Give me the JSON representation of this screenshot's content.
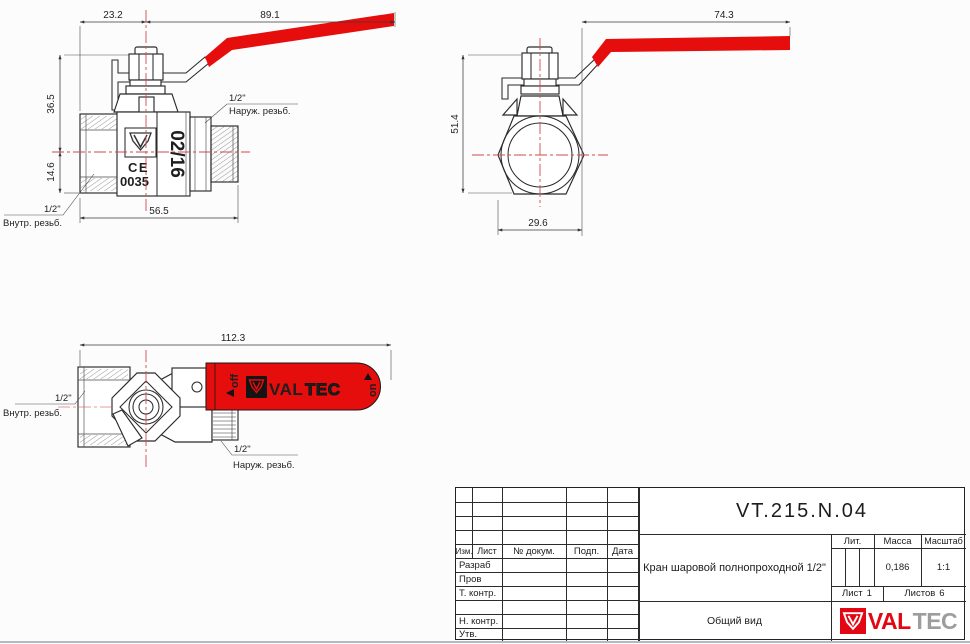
{
  "colors": {
    "handle_red": "#e60d0d",
    "centerline_red": "#cf4a4a",
    "line": "#2a2a2a",
    "valtec_red": "#e30613",
    "tec_gray": "#9d9d9c"
  },
  "views": {
    "front": {
      "dim_23_2": "23.2",
      "dim_89_1": "89.1",
      "dim_36_5": "36.5",
      "dim_14_6": "14.6",
      "dim_56_5": "56.5",
      "leader_male_size": "1/2\"",
      "leader_male_text": "Наруж. резьб.",
      "leader_female_size": "1/2\"",
      "leader_female_text": "Внутр. резьб.",
      "mark_date": "02/16",
      "mark_ce": "CE",
      "mark_code": "0035"
    },
    "side": {
      "dim_74_3": "74.3",
      "dim_51_4": "51.4",
      "dim_29_6": "29.6"
    },
    "top": {
      "dim_112_3": "112.3",
      "leader_female_size": "1/2\"",
      "leader_female_text": "Внутр. резьб.",
      "leader_male_size": "1/2\"",
      "leader_male_text": "Наруж. резьб.",
      "handle_off": "off",
      "handle_on": "on",
      "brand_val": "VAL",
      "brand_tec": "TEC"
    }
  },
  "title_block": {
    "part_number": "VT.215.N.04",
    "description": "Кран шаровой полнопроходной 1/2\"",
    "doc_type": "Общий вид",
    "col_izm": "Изм.",
    "col_list": "Лист",
    "col_doc": "№ докум.",
    "col_podp": "Подп.",
    "col_data": "Дата",
    "row_razrab": "Разраб",
    "row_prov": "Пров",
    "row_tkontr": "Т. контр.",
    "row_nkontr": "Н. контр.",
    "row_utv": "Утв.",
    "lit_label": "Лит.",
    "massa_label": "Масса",
    "massa_value": "0,186",
    "scale_label": "Масштаб",
    "scale_value": "1:1",
    "sheet_label": "Лист",
    "sheet_value": "1",
    "sheets_label": "Листов",
    "sheets_value": "6",
    "logo_val": "VAL",
    "logo_tec": "TEC"
  }
}
